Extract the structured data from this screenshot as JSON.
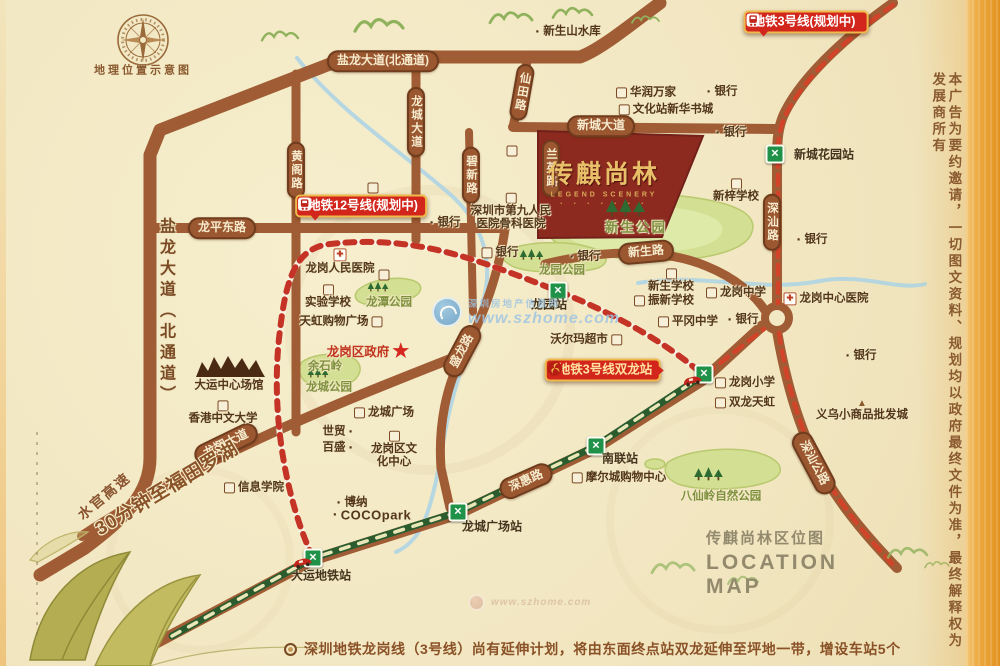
{
  "palette": {
    "paper": "#f2e8c4",
    "road_brown": "#a05c34",
    "pill_brown": "#9a5730",
    "metro_green": "#1f9148",
    "line3_green": "#2a5c2e",
    "planned_red": "#d2442a",
    "badge_red": "#d2261c",
    "badge_border_gold": "#efb94b",
    "project_red": "#8d2a20",
    "project_gold": "#e8c069",
    "park_green": "#d3df92",
    "band_orange": "#edaa41"
  },
  "compass": {
    "caption": "地理位置示意图"
  },
  "project": {
    "name": "传麒尚林",
    "subtitle": "LEGEND SCENERY",
    "dots": "· · · · · · ·"
  },
  "badges": [
    {
      "id": "line3-planned",
      "text": "地铁3号线(规划中)",
      "icon": "train",
      "icon_side": "right",
      "x": 806,
      "y": 22,
      "tail": "bl",
      "gold": false
    },
    {
      "id": "line12-planned",
      "text": "地铁12号线(规划中)",
      "icon": "train",
      "icon_side": "left",
      "x": 361,
      "y": 206,
      "tail": "bl",
      "gold": false
    },
    {
      "id": "line3-shuanglong",
      "text": "地铁3号线双龙站",
      "icon": "logo",
      "icon_side": "left",
      "x": 603,
      "y": 370,
      "tail": "r",
      "gold": true
    }
  ],
  "road_labels": [
    {
      "text": "盐龙大道(北通道)",
      "x": 383,
      "y": 61,
      "type": "pill",
      "rot": 0
    },
    {
      "text": "盐龙大道（北通道）",
      "x": 165,
      "y": 312,
      "type": "vtext",
      "rot": 0
    },
    {
      "text": "龙平东路",
      "x": 222,
      "y": 228,
      "type": "pill",
      "rot": 0
    },
    {
      "text": "黄阁路",
      "x": 296,
      "y": 170,
      "type": "vpill",
      "rot": 0
    },
    {
      "text": "龙城大道",
      "x": 416,
      "y": 122,
      "type": "vpill",
      "rot": 0
    },
    {
      "text": "仙田路",
      "x": 522,
      "y": 92,
      "type": "vpill",
      "rot": 10
    },
    {
      "text": "新城大道",
      "x": 601,
      "y": 126,
      "type": "pill",
      "rot": 0
    },
    {
      "text": "碧新路",
      "x": 471,
      "y": 175,
      "type": "vpill",
      "rot": 0
    },
    {
      "text": "兰英路",
      "x": 551,
      "y": 168,
      "type": "vpill",
      "rot": 0
    },
    {
      "text": "新生路",
      "x": 646,
      "y": 252,
      "type": "pill",
      "rot": -5
    },
    {
      "text": "盛龙路",
      "x": 462,
      "y": 351,
      "type": "pill",
      "rot": -62
    },
    {
      "text": "深汕路",
      "x": 772,
      "y": 222,
      "type": "vpill",
      "rot": 0
    },
    {
      "text": "深汕公路",
      "x": 814,
      "y": 463,
      "type": "pill",
      "rot": 62
    },
    {
      "text": "深惠路",
      "x": 526,
      "y": 481,
      "type": "pill",
      "rot": -24
    },
    {
      "text": "龙翔大道",
      "x": 226,
      "y": 444,
      "type": "pill",
      "rot": -26
    },
    {
      "text": "水官高速",
      "x": 104,
      "y": 496,
      "type": "otext",
      "rot": -40
    },
    {
      "text": "30分钟至福田罗湖",
      "x": 167,
      "y": 489,
      "type": "otext big",
      "rot": -31
    }
  ],
  "pois": [
    {
      "text": "新生山水库",
      "x": 568,
      "y": 32,
      "icon": "dot",
      "side": "left"
    },
    {
      "text": "华润万家",
      "x": 646,
      "y": 93,
      "icon": "stamp",
      "side": "left"
    },
    {
      "text": "文化站新华书城",
      "x": 666,
      "y": 110,
      "icon": "stamp",
      "side": "left"
    },
    {
      "text": "银行",
      "x": 722,
      "y": 92,
      "icon": "dot",
      "side": "left"
    },
    {
      "text": "银行",
      "x": 731,
      "y": 133,
      "icon": "dot",
      "side": "left"
    },
    {
      "text": "新梓学校",
      "x": 736,
      "y": 191,
      "icon": "stamp",
      "side": "above"
    },
    {
      "lines": [
        "深圳市第九人民",
        "医院骨科医院"
      ],
      "x": 511,
      "y": 212,
      "icon": "stamp",
      "side": "above"
    },
    {
      "text": "",
      "x": 512,
      "y": 151,
      "icon": "stamp",
      "side": "left"
    },
    {
      "text": "",
      "x": 373,
      "y": 188,
      "icon": "stamp",
      "side": "left"
    },
    {
      "text": "银行",
      "x": 445,
      "y": 223,
      "icon": "dot",
      "side": "left"
    },
    {
      "text": "银行",
      "x": 812,
      "y": 240,
      "icon": "dot",
      "side": "left"
    },
    {
      "text": "龙岗人民医院",
      "x": 340,
      "y": 262,
      "icon": "cross",
      "side": "above"
    },
    {
      "text": "实验学校",
      "x": 328,
      "y": 297,
      "icon": "stamp",
      "side": "above"
    },
    {
      "text": "天虹购物广场",
      "x": 341,
      "y": 322,
      "icon": "stamp",
      "side": "right"
    },
    {
      "text": "银行",
      "x": 500,
      "y": 253,
      "icon": "stamp",
      "side": "left"
    },
    {
      "text": "银行",
      "x": 585,
      "y": 257,
      "icon": "dot",
      "side": "left"
    },
    {
      "text": "龙潭公园",
      "x": 389,
      "y": 303,
      "cls": "park"
    },
    {
      "text": "",
      "x": 384,
      "y": 275,
      "icon": "stamp",
      "side": "left"
    },
    {
      "text": "龙岗区政府",
      "x": 368,
      "y": 352,
      "cls": "gov",
      "icon": "star",
      "side": "right"
    },
    {
      "text": "余石岭",
      "x": 325,
      "y": 367,
      "cls": "park"
    },
    {
      "text": "龙城公园",
      "x": 329,
      "y": 388,
      "cls": "park"
    },
    {
      "text": "大运中心场馆",
      "x": 229,
      "y": 386
    },
    {
      "text": "香港中文大学",
      "x": 223,
      "y": 413,
      "icon": "stamp",
      "side": "above"
    },
    {
      "text": "新生公园",
      "x": 636,
      "y": 228,
      "cls": "parkbig"
    },
    {
      "text": "龙园公园",
      "x": 562,
      "y": 271,
      "cls": "park"
    },
    {
      "text": "新生学校",
      "x": 671,
      "y": 281,
      "icon": "stamp",
      "side": "above"
    },
    {
      "text": "振新学校",
      "x": 664,
      "y": 301,
      "icon": "stamp",
      "side": "left"
    },
    {
      "text": "平冈中学",
      "x": 688,
      "y": 322,
      "icon": "stamp",
      "side": "left"
    },
    {
      "text": "龙岗中学",
      "x": 736,
      "y": 293,
      "icon": "stamp",
      "side": "left"
    },
    {
      "text": "银行",
      "x": 743,
      "y": 320,
      "icon": "dot",
      "side": "left"
    },
    {
      "text": "龙岗中心医院",
      "x": 826,
      "y": 299,
      "icon": "cross",
      "side": "left"
    },
    {
      "text": "银行",
      "x": 861,
      "y": 356,
      "icon": "dot",
      "side": "left"
    },
    {
      "text": "沃尔玛超市",
      "x": 586,
      "y": 340,
      "icon": "stamp",
      "side": "right"
    },
    {
      "text": "龙岗小学",
      "x": 745,
      "y": 383,
      "icon": "stamp",
      "side": "left"
    },
    {
      "text": "双龙天虹",
      "x": 745,
      "y": 403,
      "icon": "stamp",
      "side": "left"
    },
    {
      "text": "义乌小商品批发城",
      "x": 862,
      "y": 411,
      "icon": "tri",
      "side": "above"
    },
    {
      "text": "世贸",
      "x": 338,
      "y": 432,
      "icon": "dot",
      "side": "right"
    },
    {
      "text": "百盛",
      "x": 338,
      "y": 448,
      "icon": "dot",
      "side": "right"
    },
    {
      "text": "龙城广场",
      "x": 384,
      "y": 413,
      "icon": "stamp",
      "side": "left"
    },
    {
      "lines": [
        "龙岗区文",
        "化中心"
      ],
      "x": 394,
      "y": 450,
      "icon": "stamp",
      "side": "above"
    },
    {
      "text": "信息学院",
      "x": 254,
      "y": 488,
      "icon": "stamp",
      "side": "left"
    },
    {
      "text": "博纳",
      "x": 352,
      "y": 503,
      "icon": "dot",
      "side": "left"
    },
    {
      "text": "COCOpark",
      "x": 372,
      "y": 516,
      "icon": "dot",
      "side": "left",
      "cls": "latin"
    },
    {
      "text": "摩尔城购物中心",
      "x": 619,
      "y": 478,
      "icon": "stamp",
      "side": "left"
    },
    {
      "text": "八仙岭自然公园",
      "x": 721,
      "y": 497,
      "cls": "park"
    }
  ],
  "stations": [
    {
      "name": "新城花园站",
      "x": 775,
      "y": 154,
      "lx": 824,
      "ly": 155
    },
    {
      "name": "龙园站",
      "x": 558,
      "y": 291,
      "lx": 549,
      "ly": 305
    },
    {
      "name": "",
      "x": 704,
      "y": 374,
      "lx": 0,
      "ly": 0
    },
    {
      "name": "南联站",
      "x": 596,
      "y": 446,
      "lx": 620,
      "ly": 459
    },
    {
      "name": "龙城广场站",
      "x": 458,
      "y": 512,
      "lx": 492,
      "ly": 527
    },
    {
      "name": "大运地铁站",
      "x": 313,
      "y": 558,
      "lx": 321,
      "ly": 576
    }
  ],
  "vehicles": [
    {
      "x": 290,
      "y": 559
    },
    {
      "x": 680,
      "y": 377
    }
  ],
  "map_title": {
    "cn": "传麒尚林区位图",
    "en_line1": "LOCATION",
    "en_line2": "MAP"
  },
  "note": {
    "text": "深圳地铁龙岗线（3号线）尚有延伸计划，将由东面终点站双龙延伸至坪地一带，增设车站5个"
  },
  "disclaimer": "本广告为要约邀请，一切图文资料、规划均以政府最终文件为准，最终解释权为发展商所有",
  "watermark": {
    "name": "深圳房地产信息网",
    "site": "www.szhome.com"
  }
}
